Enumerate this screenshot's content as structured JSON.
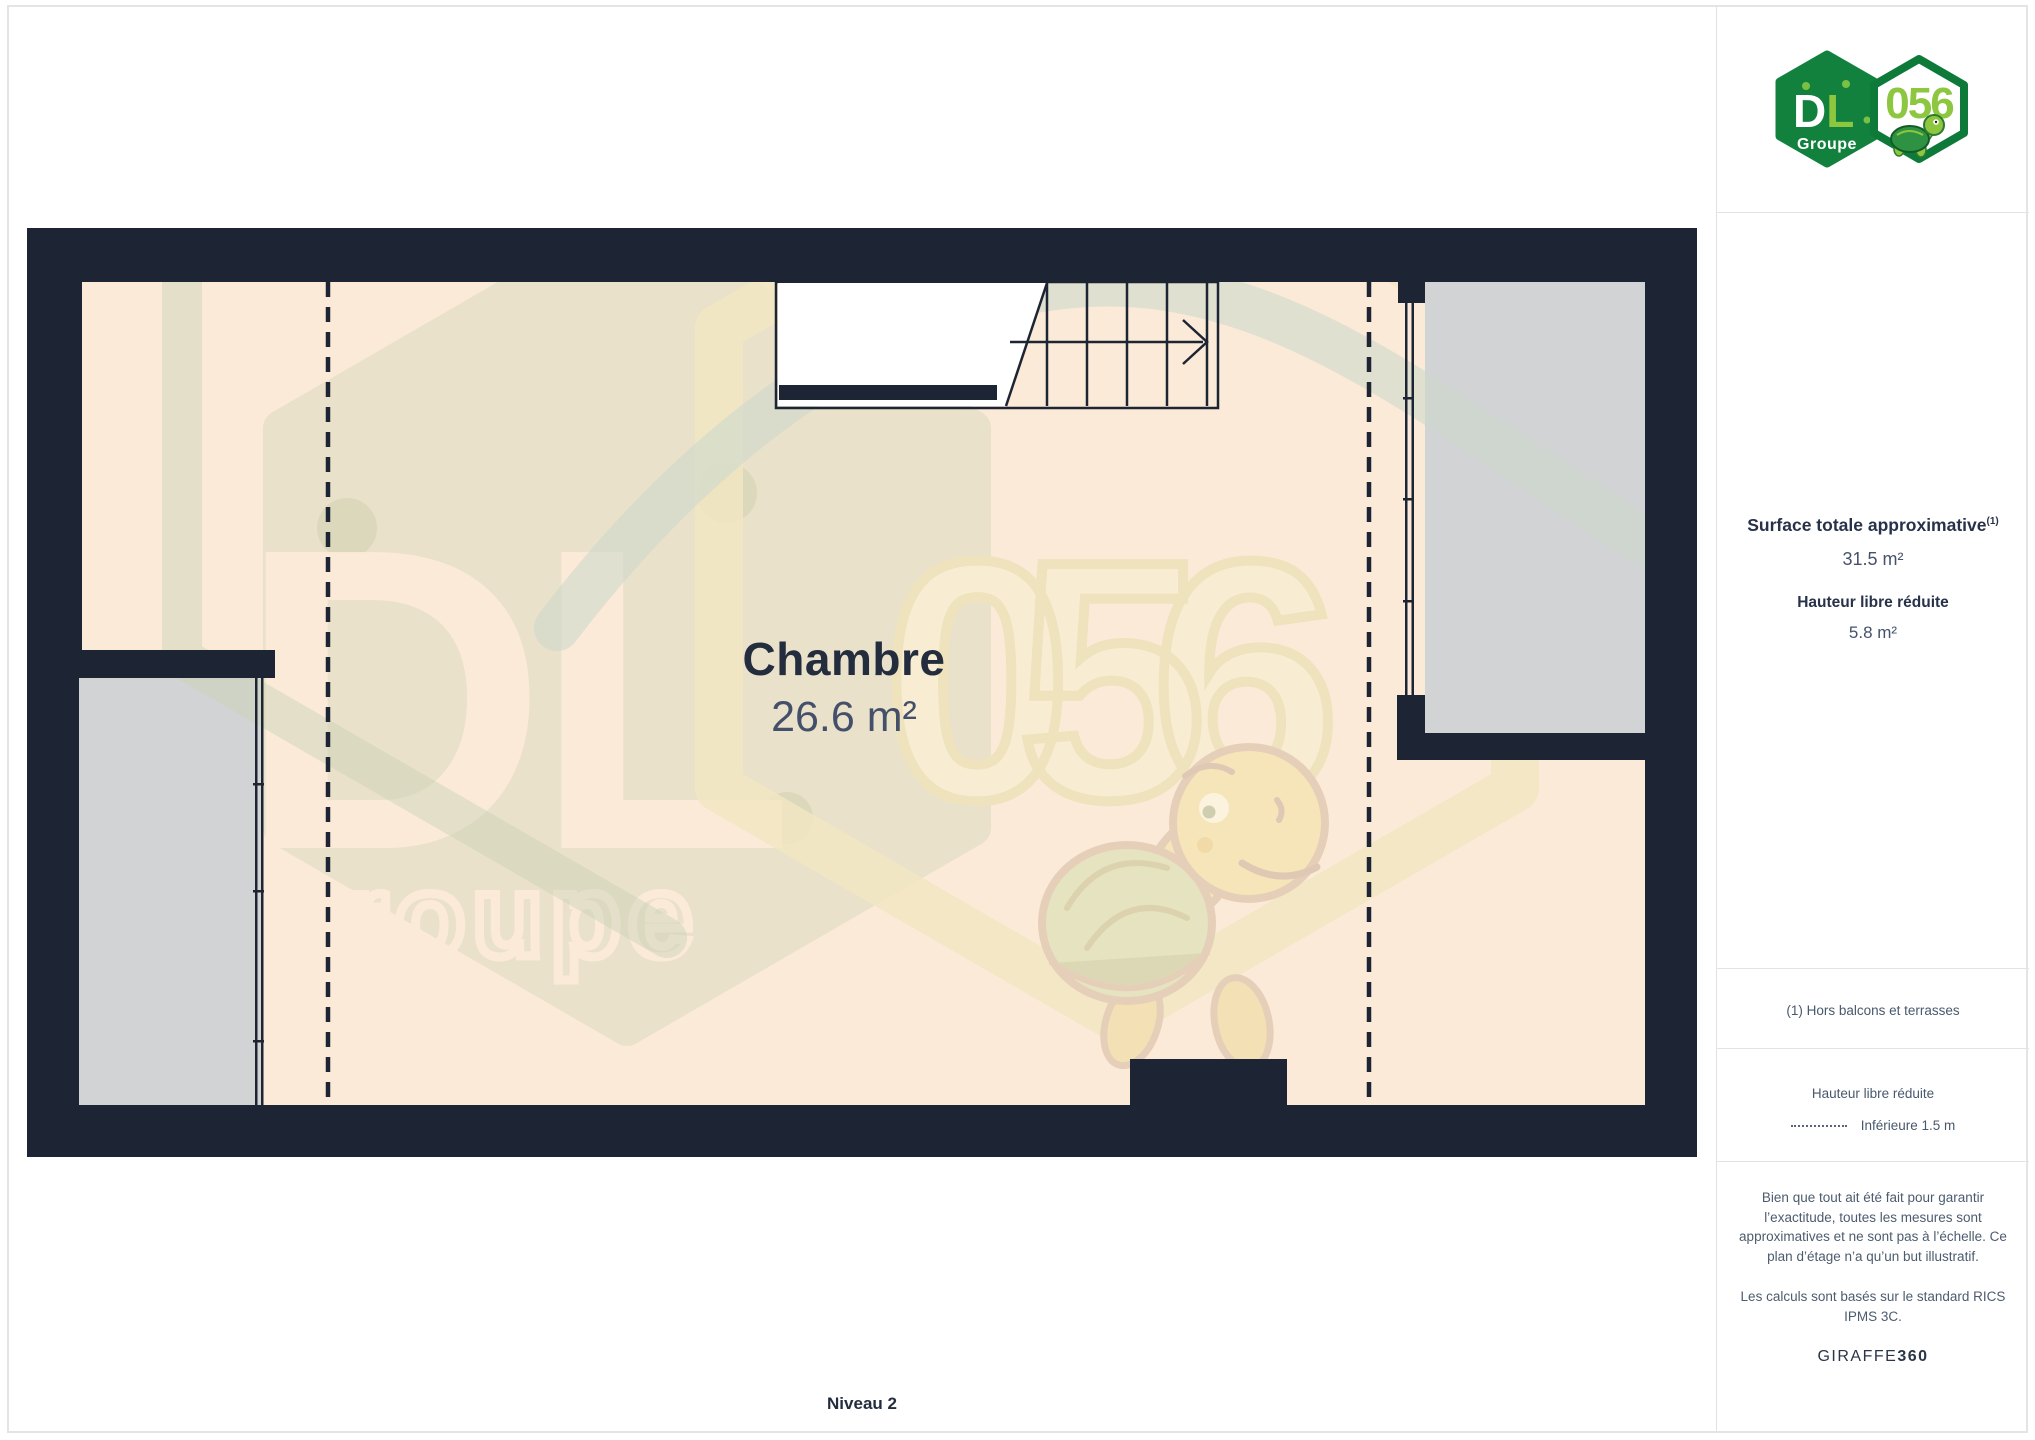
{
  "logo": {
    "dl": "DL",
    "groupe": "Groupe",
    "number": "056",
    "green_dark": "#12813e",
    "green_light": "#8dc63f"
  },
  "sidebar": {
    "surface_label": "Surface totale approximative",
    "surface_sup": "(1)",
    "surface_value": "31.5 m²",
    "height_label": "Hauteur libre réduite",
    "height_value": "5.8 m²",
    "footnote": "(1) Hors balcons et terrasses",
    "legend_title": "Hauteur libre réduite",
    "legend_dash_label": "Inférieure 1.5 m",
    "disclaimer1": "Bien que tout ait été fait pour garantir l’exactitude, toutes les mesures sont approximatives et ne sont pas à l’échelle. Ce plan d’étage n’a qu’un but illustratif.",
    "disclaimer2": "Les calculs sont basés sur le standard RICS IPMS 3C.",
    "brand": "GIRAFFE",
    "brand_bold": "360"
  },
  "plan": {
    "room_name": "Chambre",
    "room_area": "26.6 m²",
    "level_label": "Niveau 2",
    "colors": {
      "wall": "#1d2433",
      "floor": "#fcead9",
      "void_gray": "#d2d3d4",
      "watermark_sage": "#dadabe",
      "watermark_yellow": "#f1e6c2"
    }
  },
  "watermark": {
    "dl": "DL",
    "groupe": "Groupe",
    "number": "056"
  }
}
